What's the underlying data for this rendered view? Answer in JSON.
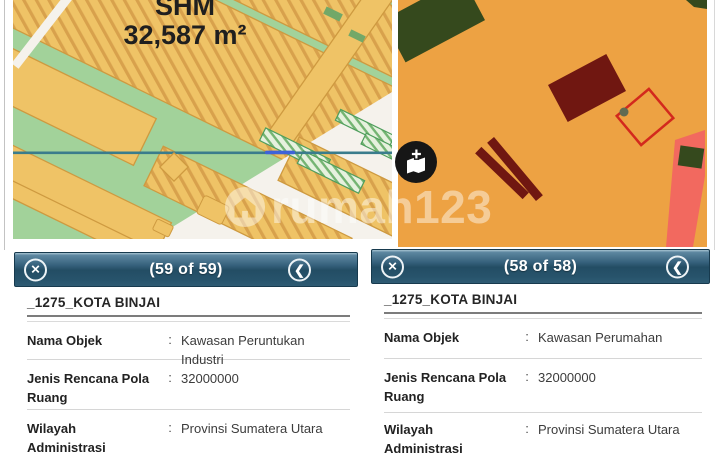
{
  "watermark": {
    "text": "rumah123",
    "logo": "rumah123-house-logo"
  },
  "left_map": {
    "parcel_label_line1": "SHM",
    "parcel_label_line2": "32,587 m²"
  },
  "right_map": {
    "selected_parcel": "red-outline-parcel",
    "marker": "gray-dot"
  },
  "icons": {
    "close": "✕",
    "back": "❮",
    "layers": "add-map-layer"
  },
  "panels": [
    {
      "header": {
        "counter": "(59 of 59)"
      },
      "region_title": "_1275_KOTA BINJAI",
      "rows": [
        {
          "label": "Nama Objek",
          "colon": ":",
          "value": "Kawasan Peruntukan Industri"
        },
        {
          "label": "Jenis Rencana Pola Ruang",
          "colon": ":",
          "value": "32000000"
        },
        {
          "label": "Wilayah Administrasi",
          "colon": ":",
          "value": "Provinsi Sumatera Utara"
        }
      ]
    },
    {
      "header": {
        "counter": "(58 of 58)"
      },
      "region_title": "_1275_KOTA BINJAI",
      "rows": [
        {
          "label": "Nama Objek",
          "colon": ":",
          "value": "Kawasan Perumahan"
        },
        {
          "label": "Jenis Rencana Pola Ruang",
          "colon": ":",
          "value": "32000000"
        },
        {
          "label": "Wilayah Administrasi",
          "colon": ":",
          "value": "Provinsi Sumatera Utara"
        }
      ]
    }
  ],
  "colors": {
    "zone_green": "#A2D29A",
    "zone_orange_light": "#EFC366",
    "zone_orange_stripe": "#D8A14C",
    "zone_orange_border": "#CE9A40",
    "zone_orange_dark": "#EDA243",
    "zone_maroon": "#701711",
    "zone_dark_green": "#35491D",
    "zone_salmon": "#F2695F",
    "road_white": "#F5F2EC",
    "boundary_teal": "#3A7C8C",
    "parcel_outline_red": "#D3291D",
    "header_blue": "#2E5B73"
  }
}
